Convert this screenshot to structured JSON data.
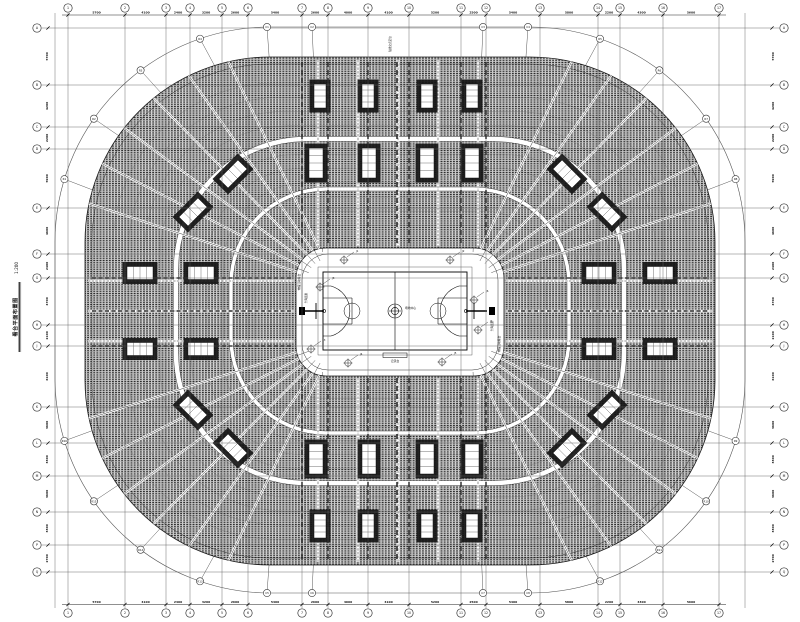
{
  "title_block": {
    "title": "看台平面布置图",
    "scale": "1:200"
  },
  "grid": {
    "top_labels": [
      "1",
      "2",
      "3",
      "4",
      "5",
      "6",
      "7",
      "8",
      "9",
      "10",
      "11",
      "12",
      "13",
      "14",
      "15",
      "16",
      "17"
    ],
    "bottom_labels": [
      "1",
      "2",
      "3",
      "4",
      "5",
      "6",
      "7",
      "8",
      "9",
      "10",
      "11",
      "12",
      "13",
      "14",
      "15",
      "16",
      "17"
    ],
    "left_labels": [
      "A",
      "B",
      "C",
      "D",
      "E",
      "F",
      "G",
      "H",
      "J",
      "K",
      "L",
      "M",
      "N",
      "P",
      "Q"
    ],
    "right_labels": [
      "A",
      "B",
      "C",
      "D",
      "E",
      "F",
      "G",
      "H",
      "J",
      "K",
      "L",
      "M",
      "N",
      "P",
      "Q"
    ],
    "arc_top_labels": [
      "C1",
      "C2",
      "C3",
      "C4"
    ],
    "arc_bottom_labels": [
      "C5",
      "C6",
      "C7",
      "C8"
    ],
    "radial_labels": [
      "R1",
      "R2",
      "R3",
      "R4",
      "R5",
      "R6",
      "R7",
      "R8",
      "R9",
      "R10",
      "R11",
      "R12",
      "R13",
      "R14",
      "R15",
      "R16"
    ]
  },
  "dimensions": {
    "top": [
      "5700",
      "4100",
      "2400",
      "3200",
      "2600",
      "5400",
      "2600",
      "4000",
      "4100",
      "5200",
      "2500",
      "5400",
      "5800",
      "2200",
      "4300",
      "5600"
    ],
    "bottom": [
      "5700",
      "4100",
      "2400",
      "3200",
      "2600",
      "5400",
      "2600",
      "4000",
      "4100",
      "5200",
      "2500",
      "5400",
      "5800",
      "2200",
      "4300",
      "5600"
    ],
    "left": [
      "5700",
      "4200",
      "2200",
      "5900",
      "4600",
      "2400",
      "4700",
      "2100",
      "6100",
      "3600",
      "3300",
      "3600",
      "3300",
      "2700"
    ],
    "right": [
      "5700",
      "4200",
      "2200",
      "5900",
      "4600",
      "2400",
      "4700",
      "2100",
      "6100",
      "3600",
      "3300",
      "3600",
      "3300",
      "2700"
    ]
  },
  "annotations": {
    "center_point": "场地中心",
    "scorer_table": "记录台",
    "hoop_left": "升降篮架",
    "hoop_right": "升降篮架",
    "retractable_stand_left": "伸缩活动看台",
    "retractable_stand_right": "伸缩活动看台",
    "top_note": "轴线交点定位",
    "markers": [
      "J1",
      "J2",
      "J3",
      "J4",
      "J5",
      "J6",
      "J7",
      "J8"
    ]
  },
  "colors": {
    "line": "#1a1a1a",
    "grid": "#606060",
    "seat": "#262626",
    "band": "#777777",
    "white": "#ffffff"
  }
}
